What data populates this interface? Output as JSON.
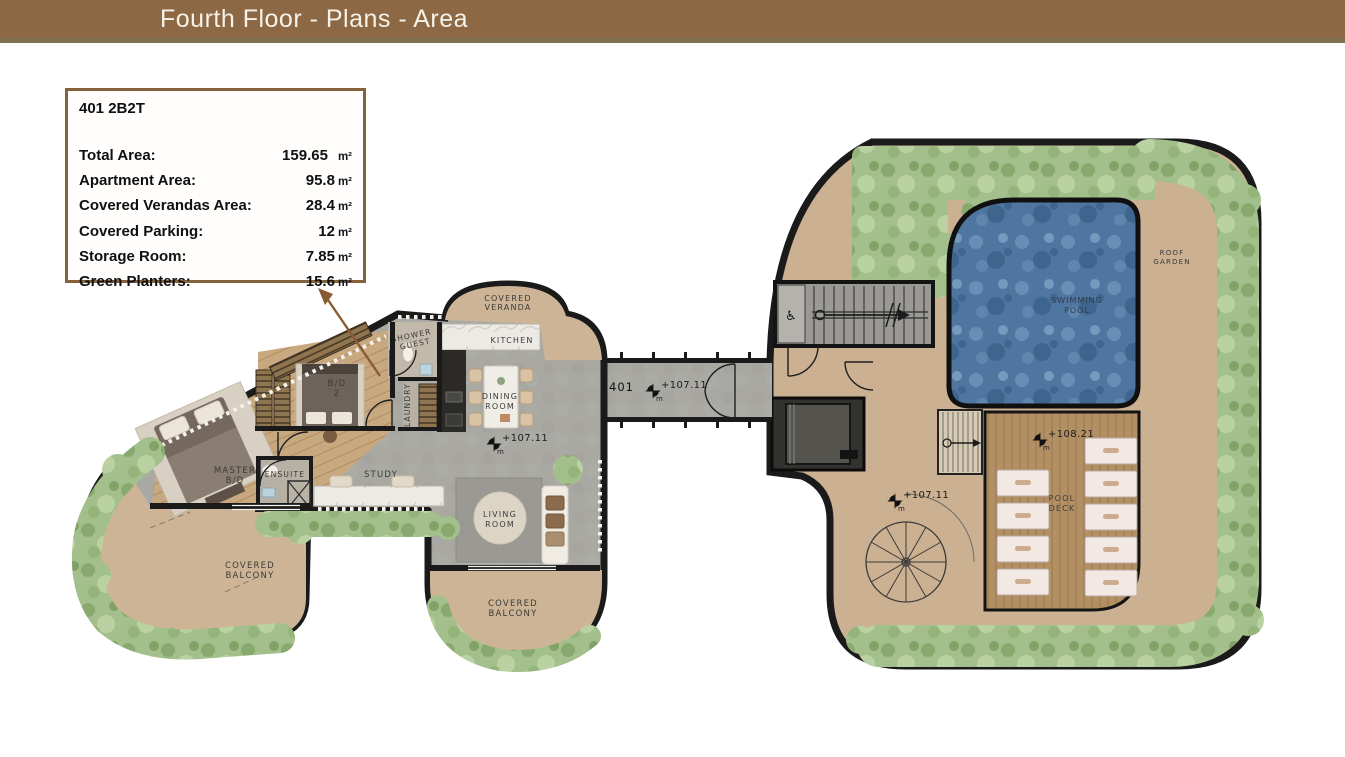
{
  "header": {
    "title": "Fourth Floor - Plans - Area"
  },
  "info_box": {
    "unit_title": "401 2B2T",
    "rows": [
      {
        "label": "Total Area:",
        "value": "159.65",
        "unit": "m²"
      },
      {
        "label": "Apartment Area:",
        "value": "95.8",
        "unit": "m²"
      },
      {
        "label": "Covered Verandas Area:",
        "value": "28.4",
        "unit": "m²"
      },
      {
        "label": "Covered Parking:",
        "value": "12",
        "unit": "m²"
      },
      {
        "label": "Storage Room:",
        "value": "7.85",
        "unit": "m²"
      },
      {
        "label": "Green Planters:",
        "value": "15.6",
        "unit": "m²"
      }
    ]
  },
  "plan": {
    "labels": {
      "covered_veranda": [
        "COVERED",
        "VERANDA"
      ],
      "shower_guest": [
        "SHOWER",
        "GUEST"
      ],
      "kitchen": "KITCHEN",
      "laundry": "LAUNDRY",
      "dining_room": [
        "DINING",
        "ROOM"
      ],
      "bedroom2": [
        "B/D",
        "2"
      ],
      "master_bedroom": [
        "MASTER",
        "B/D"
      ],
      "ensuite": "ENSUITE",
      "study": "STUDY",
      "living_room": [
        "LIVING",
        "ROOM"
      ],
      "covered_balcony_west": [
        "COVERED",
        "BALCONY"
      ],
      "covered_balcony_south": [
        "COVERED",
        "BALCONY"
      ],
      "swimming_pool": [
        "SWIMMING",
        "POOL"
      ],
      "pool_deck": [
        "POOL",
        "DECK"
      ],
      "roof_garden": [
        "ROOF",
        "GARDEN"
      ]
    },
    "markers": {
      "unit_number": "401",
      "meter": "m",
      "elevations": {
        "dining": "+107.11",
        "corridor": "+107.11",
        "walkway": "+107.11",
        "pool_deck": "+108.21"
      }
    },
    "icons": {
      "accessible": "♿"
    },
    "colors": {
      "header_brown": "#8d6844",
      "header_strip": "#80704f",
      "box_border": "#85613c",
      "arrow_brown": "#8a5a33",
      "wall_black": "#1a1a1a",
      "floor_gray": "#a9a8a2",
      "floor_beige": "#cdb496",
      "wood": "#c8a87e",
      "deck_wood": "#b29064",
      "pool_water": "#4f76a0",
      "planter_green": "#a3c08c"
    }
  }
}
